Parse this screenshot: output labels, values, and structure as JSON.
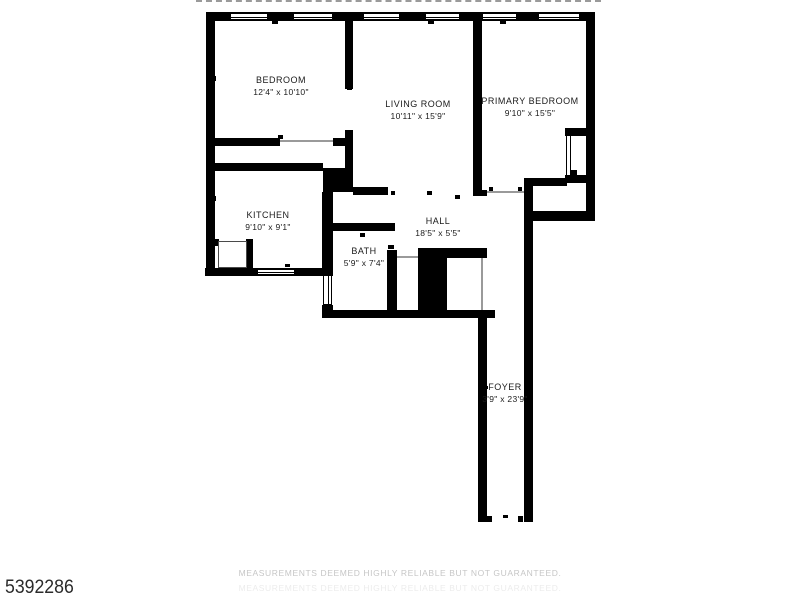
{
  "meta": {
    "listing_id": "5392286",
    "disclaimer": "MEASUREMENTS DEEMED HIGHLY RELIABLE BUT NOT GUARANTEED."
  },
  "colors": {
    "wall": "#000000",
    "door_line": "#9a9a9a",
    "watermark": "#c6c6c6",
    "id_text": "#2b2b2b"
  },
  "floorplan": {
    "rooms": [
      {
        "id": "bedroom",
        "name": "BEDROOM",
        "dims": "12'4\" x 10'10\"",
        "cx": 281,
        "cy": 86
      },
      {
        "id": "living-room",
        "name": "LIVING ROOM",
        "dims": "10'11\" x 15'9\"",
        "cx": 418,
        "cy": 110
      },
      {
        "id": "primary-bedroom",
        "name": "PRIMARY BEDROOM",
        "dims": "9'10\" x 15'5\"",
        "cx": 530,
        "cy": 107
      },
      {
        "id": "kitchen",
        "name": "KITCHEN",
        "dims": "9'10\" x 9'1\"",
        "cx": 268,
        "cy": 221
      },
      {
        "id": "hall",
        "name": "HALL",
        "dims": "18'5\" x 5'5\"",
        "cx": 438,
        "cy": 227
      },
      {
        "id": "bath",
        "name": "BATH",
        "dims": "5'9\" x 7'4\"",
        "cx": 364,
        "cy": 257
      },
      {
        "id": "foyer",
        "name": "FOYER",
        "dims": "3'9\" x 23'9\"",
        "cx": 505,
        "cy": 393
      }
    ],
    "walls": [
      [
        207,
        12,
        388,
        9
      ],
      [
        206,
        12,
        9,
        264
      ],
      [
        586,
        12,
        9,
        209
      ],
      [
        345,
        21,
        8,
        68
      ],
      [
        345,
        130,
        8,
        62
      ],
      [
        206,
        138,
        74,
        8
      ],
      [
        333,
        138,
        20,
        8
      ],
      [
        206,
        163,
        117,
        8
      ],
      [
        323,
        168,
        30,
        24
      ],
      [
        353,
        187,
        35,
        8
      ],
      [
        322,
        192,
        11,
        83
      ],
      [
        322,
        305,
        11,
        13
      ],
      [
        205,
        268,
        128,
        8
      ],
      [
        213,
        239,
        6,
        7
      ],
      [
        246,
        239,
        7,
        30
      ],
      [
        322,
        223,
        73,
        8
      ],
      [
        387,
        250,
        10,
        68
      ],
      [
        418,
        248,
        69,
        10
      ],
      [
        418,
        255,
        29,
        63
      ],
      [
        322,
        310,
        173,
        8
      ],
      [
        478,
        310,
        9,
        212
      ],
      [
        524,
        178,
        9,
        344
      ],
      [
        524,
        178,
        43,
        8
      ],
      [
        568,
        170,
        9,
        9
      ],
      [
        524,
        211,
        71,
        10
      ],
      [
        473,
        190,
        14,
        6
      ],
      [
        473,
        21,
        9,
        175
      ],
      [
        565,
        128,
        22,
        8
      ],
      [
        565,
        175,
        22,
        8
      ],
      [
        487,
        516,
        5,
        6
      ],
      [
        518,
        516,
        5,
        6
      ]
    ],
    "windows": [
      {
        "r": [
          230,
          13,
          38,
          7
        ],
        "o": "h"
      },
      {
        "r": [
          293,
          13,
          40,
          7
        ],
        "o": "h"
      },
      {
        "r": [
          363,
          13,
          37,
          7
        ],
        "o": "h"
      },
      {
        "r": [
          425,
          13,
          35,
          7
        ],
        "o": "h"
      },
      {
        "r": [
          482,
          13,
          35,
          7
        ],
        "o": "h"
      },
      {
        "r": [
          538,
          13,
          42,
          7
        ],
        "o": "h"
      },
      {
        "r": [
          257,
          269,
          38,
          6
        ],
        "o": "h"
      },
      {
        "r": [
          323,
          275,
          9,
          30
        ],
        "o": "v"
      }
    ],
    "door_lines": [
      [
        280,
        140,
        53,
        2
      ],
      [
        487,
        191,
        37,
        2
      ],
      [
        397,
        256,
        21,
        2
      ],
      [
        481,
        258,
        2,
        52
      ]
    ],
    "double_lines": [
      [
        566,
        136,
        5,
        39
      ]
    ],
    "thin_rects": [
      [
        218,
        241,
        29,
        27
      ]
    ],
    "ticks": [
      [
        347,
        86,
        5,
        4
      ],
      [
        278,
        135,
        5,
        4
      ],
      [
        212,
        76,
        4,
        5
      ],
      [
        212,
        196,
        4,
        5
      ],
      [
        283,
        167,
        5,
        4
      ],
      [
        360,
        233,
        5,
        4
      ],
      [
        388,
        245,
        6,
        4
      ],
      [
        427,
        191,
        5,
        4
      ],
      [
        391,
        191,
        4,
        4
      ],
      [
        455,
        195,
        5,
        4
      ],
      [
        489,
        187,
        4,
        4
      ],
      [
        518,
        187,
        4,
        4
      ],
      [
        484,
        386,
        4,
        3
      ],
      [
        525,
        386,
        4,
        3
      ],
      [
        503,
        515,
        5,
        3
      ],
      [
        285,
        264,
        5,
        3
      ],
      [
        458,
        251,
        5,
        4
      ],
      [
        428,
        21,
        6,
        3
      ],
      [
        500,
        21,
        6,
        3
      ],
      [
        272,
        21,
        6,
        3
      ]
    ]
  }
}
